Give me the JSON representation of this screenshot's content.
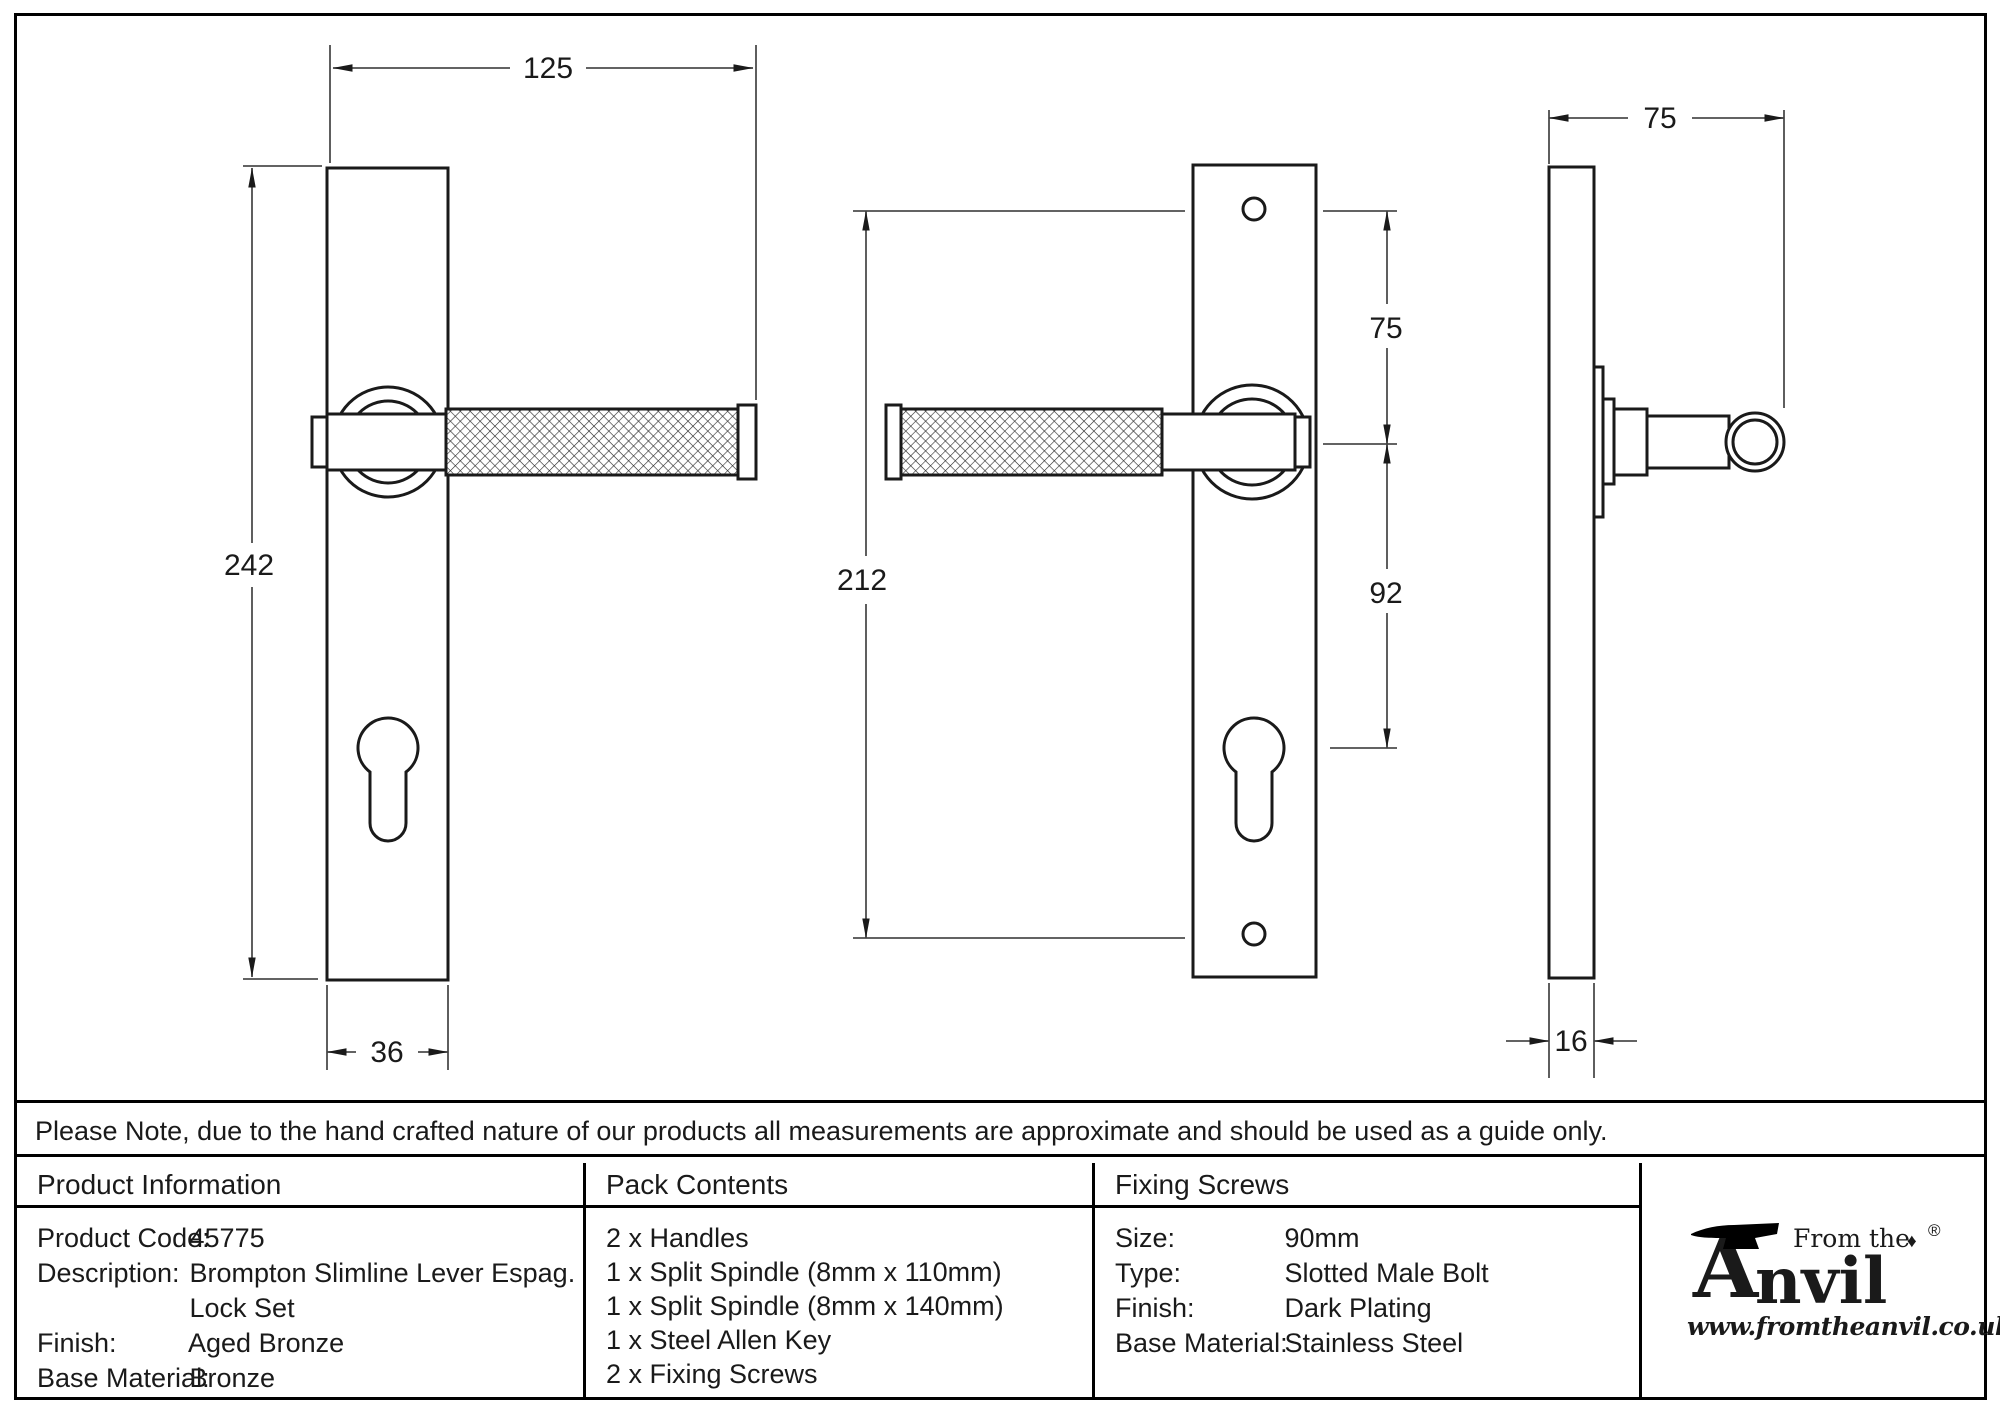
{
  "drawings": {
    "front": {
      "overall_width": "125",
      "overall_height": "242",
      "plate_width": "36"
    },
    "back": {
      "screw_centres": "212",
      "top_hole_to_handle": "75",
      "handle_to_cylinder": "92"
    },
    "side": {
      "projection": "75",
      "plate_depth": "16"
    }
  },
  "note": "Please Note, due to the hand crafted nature of our products all measurements are approximate and should be used as a guide only.",
  "product_information": {
    "title": "Product Information",
    "rows": [
      {
        "label": "Product Code:",
        "value": "45775"
      },
      {
        "label": "Description:",
        "value": "Brompton Slimline Lever Espag."
      },
      {
        "label": "",
        "value": "Lock Set"
      },
      {
        "label": "Finish:",
        "value": "Aged Bronze"
      },
      {
        "label": "Base Material:",
        "value": "Bronze"
      }
    ]
  },
  "pack_contents": {
    "title": "Pack Contents",
    "items": [
      "2 x Handles",
      "1 x Split Spindle (8mm x 110mm)",
      "1 x Split Spindle (8mm x 140mm)",
      "1 x Steel Allen Key",
      "2 x Fixing Screws"
    ]
  },
  "fixing_screws": {
    "title": "Fixing Screws",
    "rows": [
      {
        "label": "Size:",
        "value": "90mm"
      },
      {
        "label": "Type:",
        "value": "Slotted Male Bolt"
      },
      {
        "label": "Finish:",
        "value": "Dark Plating"
      },
      {
        "label": "Base Material:",
        "value": "Stainless Steel"
      }
    ]
  },
  "logo": {
    "prefix": "From the",
    "initial": "A",
    "rest": "nvil",
    "diamond": "♦",
    "registered": "®",
    "website": "www.fromtheanvil.co.uk"
  }
}
